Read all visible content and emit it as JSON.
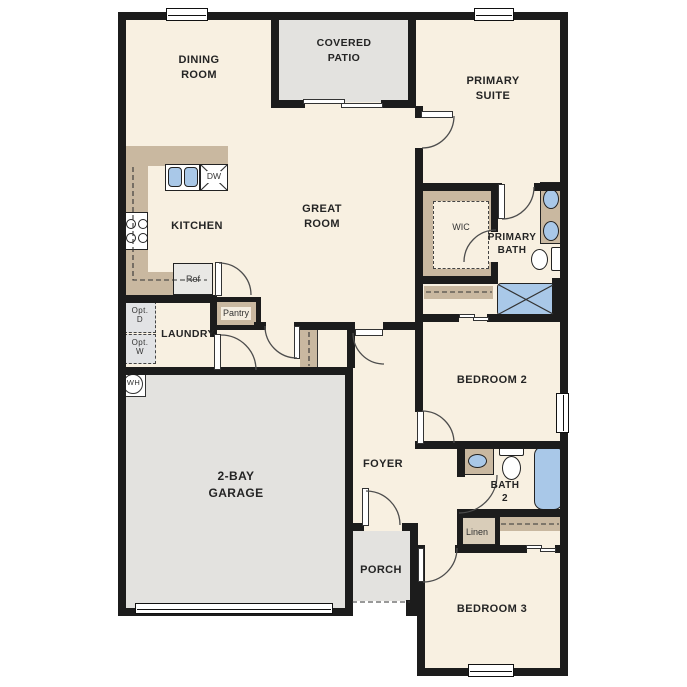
{
  "app": {
    "type": "residential-floor-plan",
    "title": "Single story floor plan"
  },
  "labels": {
    "dining_room": "DINING\nROOM",
    "covered_patio": "COVERED\nPATIO",
    "primary_suite": "PRIMARY\nSUITE",
    "great_room": "GREAT\nROOM",
    "kitchen": "KITCHEN",
    "wic": "WIC",
    "primary_bath": "PRIMARY\nBATH",
    "laundry": "LAUNDRY",
    "pantry": "Pantry",
    "ref": "Ref",
    "dw": "DW",
    "opt_d": "Opt.\nD",
    "opt_w": "Opt.\nW",
    "wh": "WH",
    "garage": "2-BAY\nGARAGE",
    "foyer": "FOYER",
    "bedroom_2": "BEDROOM 2",
    "bath_2": "BATH\n2",
    "linen": "Linen",
    "porch": "PORCH",
    "bedroom_3": "BEDROOM 3"
  },
  "fixtures": [
    "kitchen-sink",
    "dishwasher",
    "range-cooktop",
    "refrigerator",
    "primary-bath-double-vanity",
    "primary-bath-toilet",
    "walk-in-shower",
    "bath2-vanity",
    "bath2-toilet",
    "bathtub",
    "water-heater",
    "optional-dryer",
    "optional-washer",
    "linen-closet",
    "coat-closet",
    "bedroom2-closet",
    "bedroom3-closet"
  ],
  "colors": {
    "floor": "#f8f0e1",
    "exterior_space": "#e3e2df",
    "casework_tan": "#c9b8a0",
    "fixture_blue": "#a9c8e8",
    "walls": "#1c1c1c",
    "text": "#242424"
  }
}
